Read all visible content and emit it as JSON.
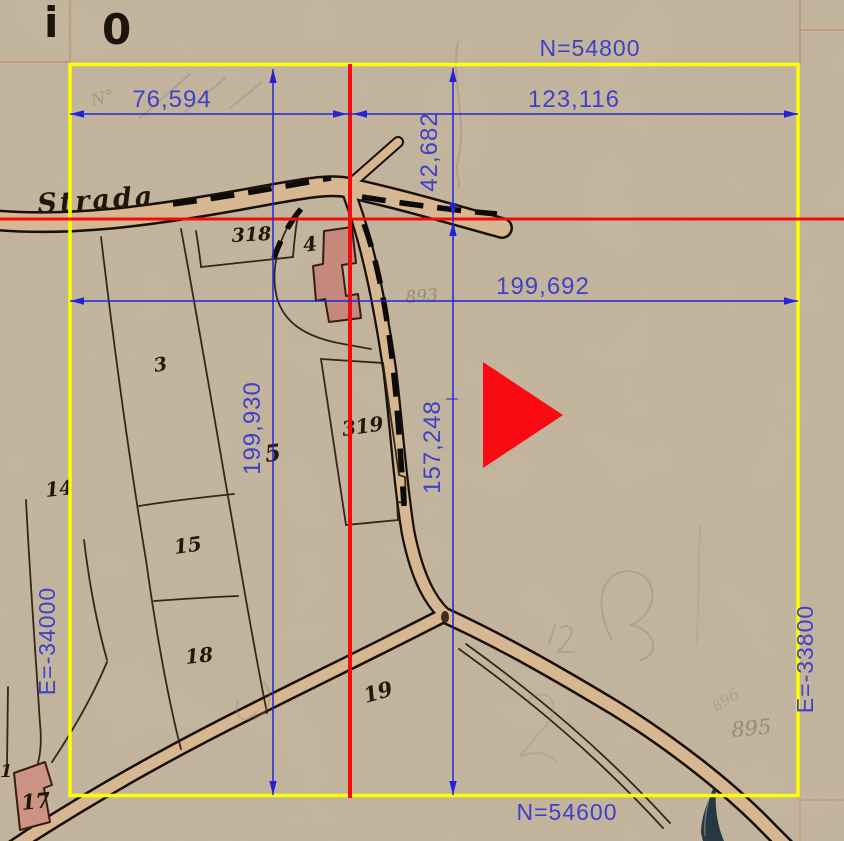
{
  "frame": {
    "n_top": "N=54800",
    "n_bottom": "N=54600",
    "e_left": "E=-34000",
    "e_right": "E=-33800"
  },
  "dims": {
    "top_left_width": "76,594",
    "top_right_width": "123,116",
    "upper_height": "42,682",
    "full_width": "199,692",
    "full_height": "199,930",
    "lower_height": "157,248"
  },
  "map": {
    "road_label": "Strada",
    "parcels": {
      "p318": "318",
      "p4": "4",
      "p3": "3",
      "p5": "5",
      "p14": "14",
      "p15": "15",
      "p18": "18",
      "p19": "19",
      "p17": "17",
      "p319": "319",
      "p1": "1"
    },
    "pencil_notes": {
      "n893": "893",
      "n895": "895",
      "n896": "896",
      "corner_note": "N°"
    },
    "margin_fragments": {
      "a": "i",
      "b": "0"
    }
  },
  "colors": {
    "paper": "#cfc1a9",
    "grid_yellow": "#ffff00",
    "crosshair_red": "#f40b0b",
    "dimension_blue": "#2424d6",
    "label_blue": "#4040c9",
    "road_tan": "#d7b791",
    "ink_black": "#181008",
    "building_pink": "#c4897b",
    "marker_red": "#fa0a12",
    "scan_pink": "#c4614d",
    "pen_navy": "#1b2e3b"
  },
  "marker": {
    "type": "solid-triangle-right"
  }
}
